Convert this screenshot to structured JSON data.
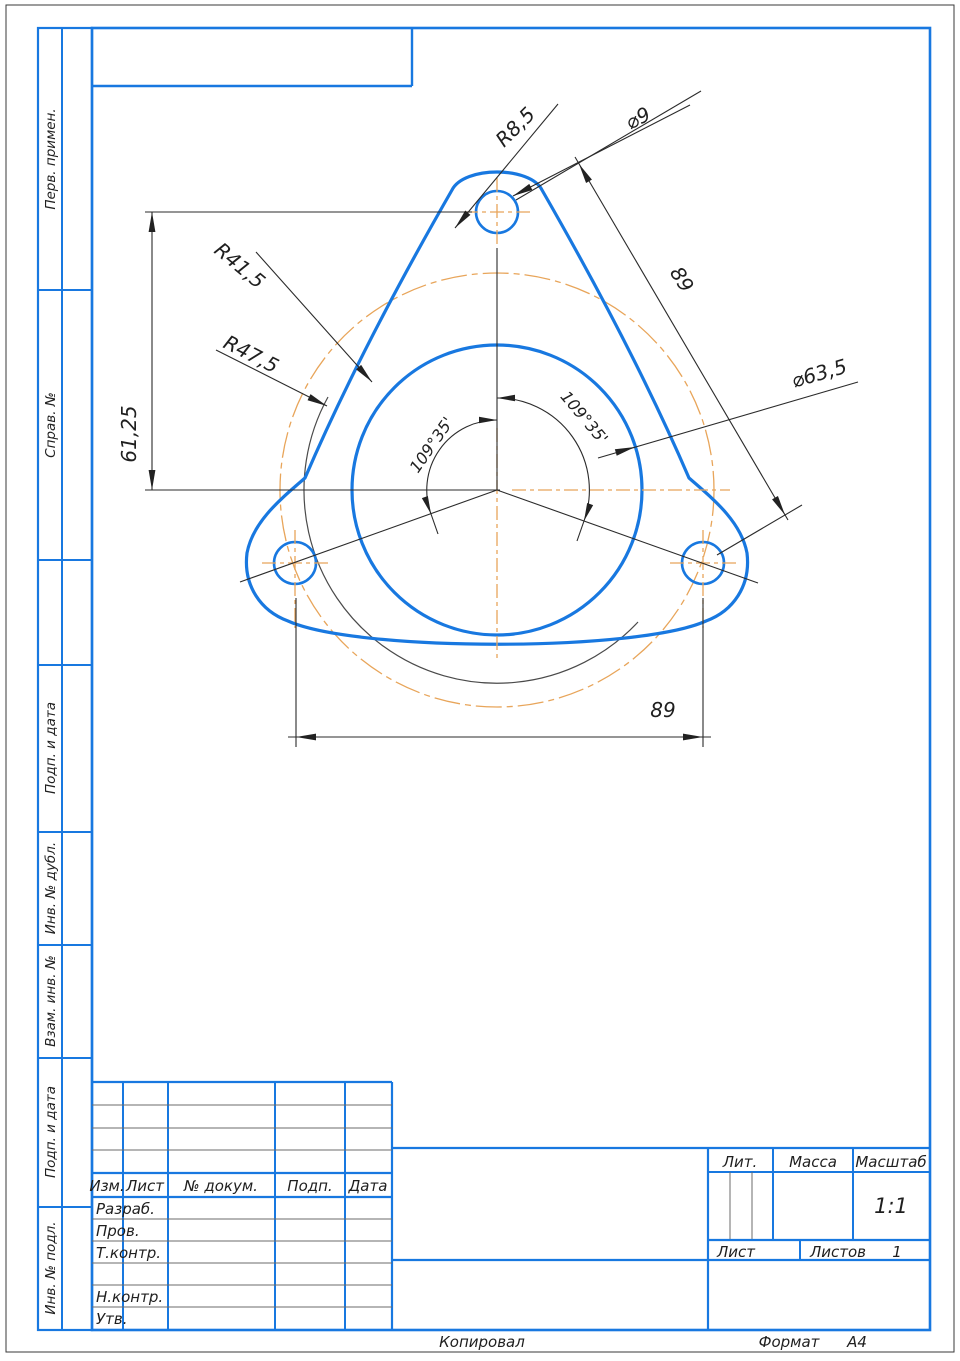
{
  "page": {
    "copied_label": "Копировал",
    "format_label": "Формат",
    "format_value": "А4"
  },
  "colors": {
    "frame_blue": "#1878e0",
    "centerline_orange": "#e8a55a",
    "dimension_gray": "#2b2b2b",
    "background": "#ffffff"
  },
  "sidebar": {
    "items": [
      {
        "label": "Перв. примен."
      },
      {
        "label": "Справ. №"
      },
      {
        "label": "Подп. и дата"
      },
      {
        "label": "Инв. № дубл."
      },
      {
        "label": "Взам. инв. №"
      },
      {
        "label": "Подп. и дата"
      },
      {
        "label": "Инв. № подл."
      }
    ]
  },
  "title_block": {
    "revision_columns": [
      "Изм.",
      "Лист",
      "№ докум.",
      "Подп.",
      "Дата"
    ],
    "signature_rows": [
      "Разраб.",
      "Пров.",
      "Т.контр.",
      "Н.контр.",
      "Утв."
    ],
    "lit_label": "Лит.",
    "mass_label": "Масса",
    "scale_label": "Масштаб",
    "scale_value": "1:1",
    "sheet_label": "Лист",
    "sheets_label": "Листов",
    "sheets_value": "1"
  },
  "dimensions": {
    "fillet_radius": "R8,5",
    "hole_diameter": "⌀9",
    "hole_spacing_diagonal": "89",
    "flange_radius": "R41,5",
    "construction_radius": "R47,5",
    "hole_vertical_offset": "61,25",
    "bore_diameter": "⌀63,5",
    "angle_left": "109°35'",
    "angle_right": "109°35'",
    "hole_spacing_horizontal": "89"
  }
}
